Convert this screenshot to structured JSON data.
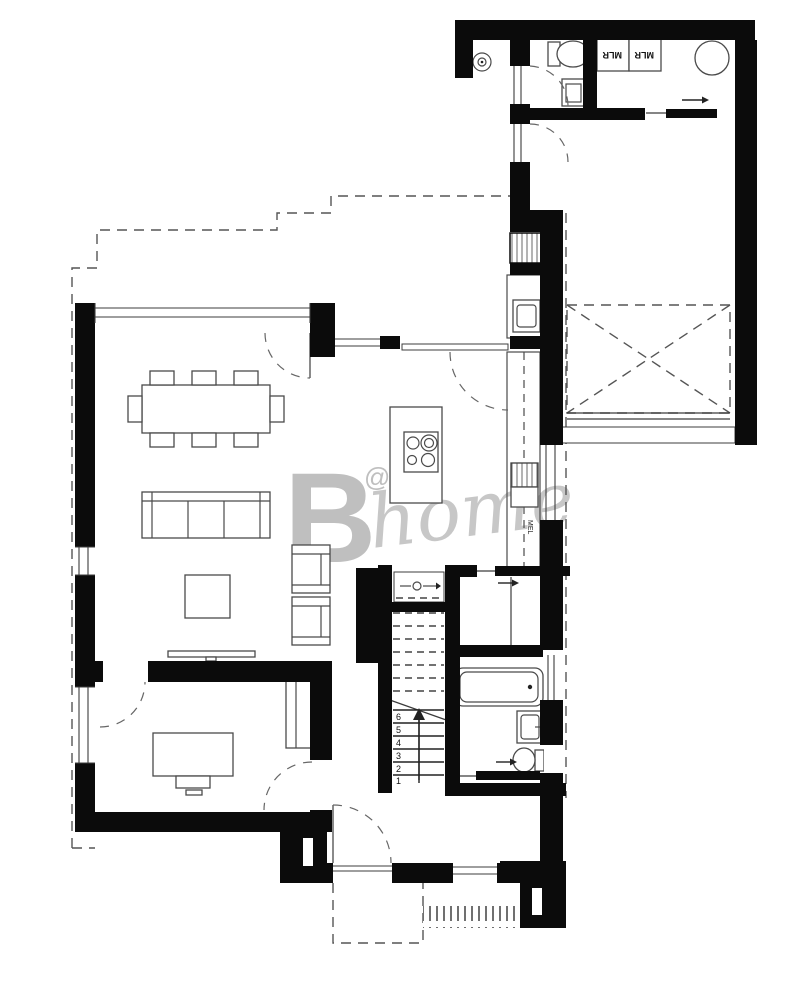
{
  "title": "floor-plan",
  "watermark": {
    "b": "B",
    "at": "@",
    "home": "home"
  },
  "labels": {
    "appliance_left": "MLR",
    "appliance_right": "MLR",
    "kitchen_unit": "MEL"
  },
  "stairs": {
    "numbers": [
      "6",
      "5",
      "4",
      "3",
      "2",
      "1"
    ]
  },
  "colors": {
    "wall": "#0b0b0b",
    "line": "#3c3c3c",
    "furniture": "#4a4a4a",
    "dashed": "#555555",
    "watermark": "#bfbfbf",
    "background": "#ffffff"
  }
}
